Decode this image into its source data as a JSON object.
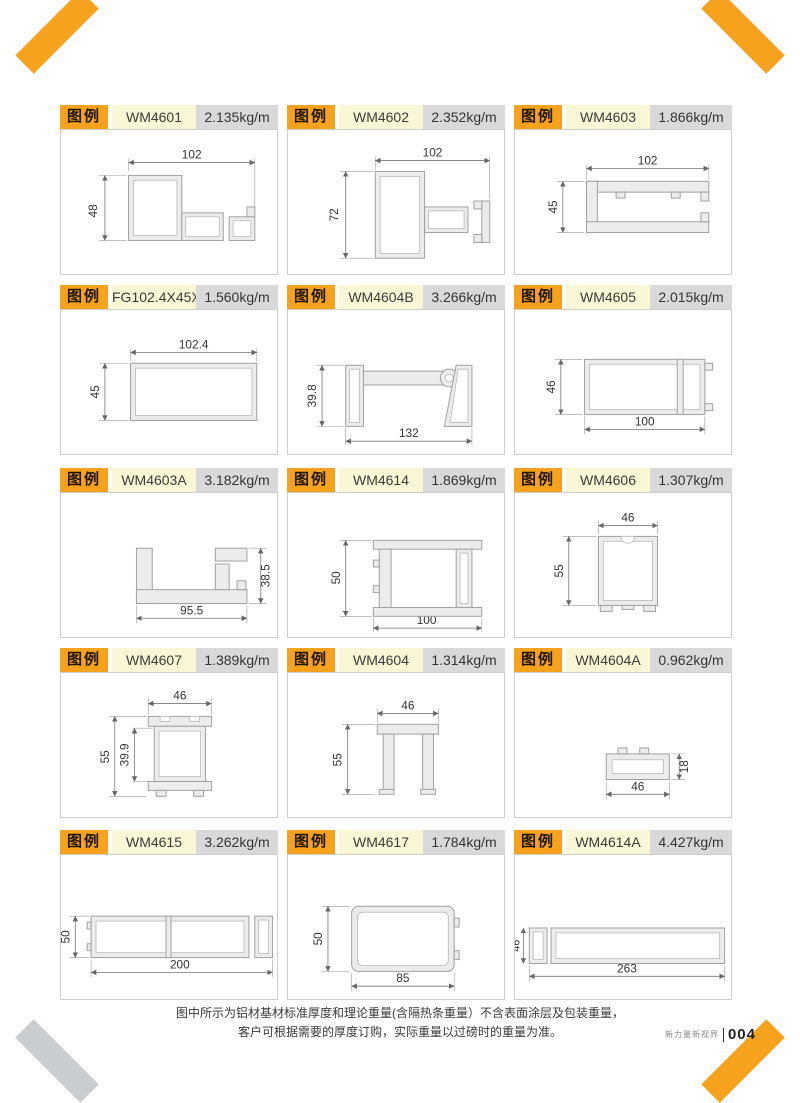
{
  "labels": {
    "legend": "图例"
  },
  "page": {
    "footer_note_line1": "图中所示为铝材基材标准厚度和理论重量(含隔热条重量）不含表面涂层及包装重量，",
    "footer_note_line2": "客户可根据需要的厚度订购，实际重量以过磅时的重量为准。",
    "footer_brand": "新力量新视界",
    "page_number": "004"
  },
  "colors": {
    "accent_orange": "#F6A21C",
    "model_bg": "#FAF7D6",
    "weight_bg": "#D9D9D9",
    "ribbon_gray": "#C9CDD0",
    "profile_fill": "#ECECEC"
  },
  "cells": [
    {
      "model": "WM4601",
      "weight": "2.135kg/m",
      "dims": [
        "102",
        "48"
      ]
    },
    {
      "model": "WM4602",
      "weight": "2.352kg/m",
      "dims": [
        "102",
        "72"
      ]
    },
    {
      "model": "WM4603",
      "weight": "1.866kg/m",
      "dims": [
        "102",
        "45"
      ]
    },
    {
      "model": "FG102.4X45X2.0",
      "weight": "1.560kg/m",
      "dims": [
        "102.4",
        "45"
      ]
    },
    {
      "model": "WM4604B",
      "weight": "3.266kg/m",
      "dims": [
        "39.8",
        "132"
      ]
    },
    {
      "model": "WM4605",
      "weight": "2.015kg/m",
      "dims": [
        "46",
        "100"
      ]
    },
    {
      "model": "WM4603A",
      "weight": "3.182kg/m",
      "dims": [
        "38.5",
        "95.5"
      ]
    },
    {
      "model": "WM4614",
      "weight": "1.869kg/m",
      "dims": [
        "50",
        "100"
      ]
    },
    {
      "model": "WM4606",
      "weight": "1.307kg/m",
      "dims": [
        "46",
        "55"
      ]
    },
    {
      "model": "WM4607",
      "weight": "1.389kg/m",
      "dims": [
        "46",
        "55",
        "39.9"
      ]
    },
    {
      "model": "WM4604",
      "weight": "1.314kg/m",
      "dims": [
        "46",
        "55"
      ]
    },
    {
      "model": "WM4604A",
      "weight": "0.962kg/m",
      "dims": [
        "18",
        "46"
      ]
    },
    {
      "model": "WM4615",
      "weight": "3.262kg/m",
      "dims": [
        "50",
        "200"
      ]
    },
    {
      "model": "WM4617",
      "weight": "1.784kg/m",
      "dims": [
        "50",
        "85"
      ]
    },
    {
      "model": "WM4614A",
      "weight": "4.427kg/m",
      "dims": [
        "46",
        "37",
        "263"
      ]
    }
  ]
}
